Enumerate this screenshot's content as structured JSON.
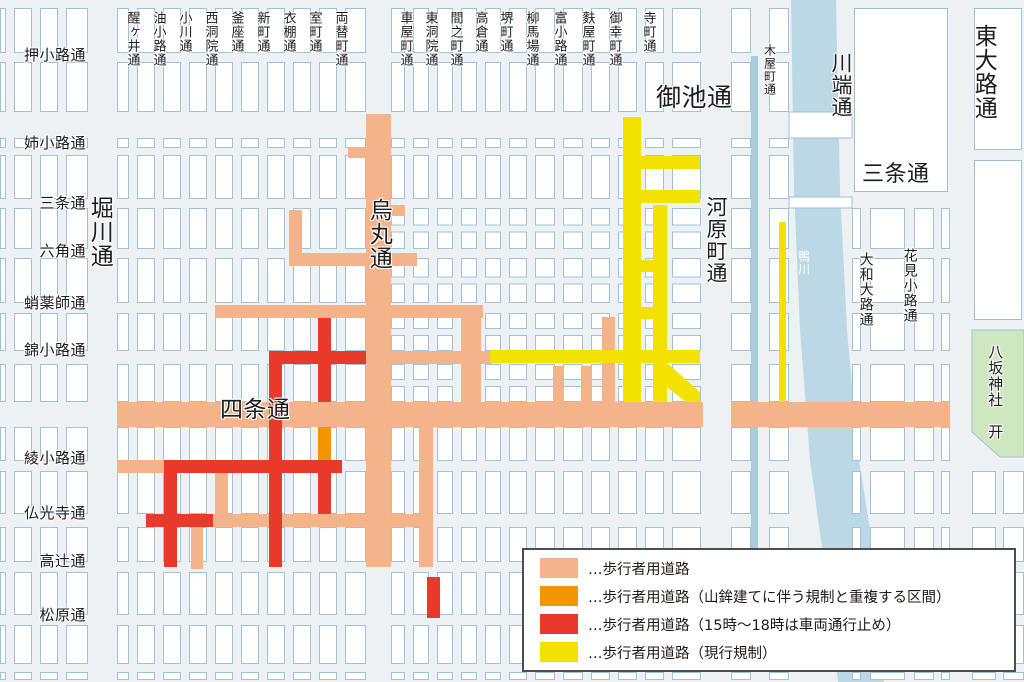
{
  "map_title": "祇園祭 歩行者用道路規制図",
  "colors": {
    "background": "#edf1f3",
    "block_fill": "#ffffff",
    "block_stroke": "#a0c2d2",
    "pedestrian": "#f4b388",
    "overlap": "#f29600",
    "timed": "#e8392b",
    "current": "#f3e100",
    "river": "#bcd8e6",
    "canal": "#a9cbde",
    "shrine_fill": "#cfe7c1",
    "label_color": "#1c1c1c",
    "river_label_color": "#ffffff",
    "legend_border": "#4d4d4d",
    "legend_text": "#231815"
  },
  "legend": {
    "items": [
      {
        "key": "pedestrian",
        "label": "…歩行者用道路"
      },
      {
        "key": "overlap",
        "label": "…歩行者用道路（山鉾建てに伴う規制と重複する区間）"
      },
      {
        "key": "timed",
        "label": "…歩行者用道路（15時〜18時は車両通行止め）"
      },
      {
        "key": "current",
        "label": "…歩行者用道路（現行規制）"
      }
    ]
  },
  "labels": {
    "top_vertical": [
      {
        "text": "醒ヶ井通",
        "x": 133
      },
      {
        "text": "油小路通",
        "x": 159
      },
      {
        "text": "小川通",
        "x": 185
      },
      {
        "text": "西洞院通",
        "x": 211
      },
      {
        "text": "釜座通",
        "x": 237
      },
      {
        "text": "新町通",
        "x": 263
      },
      {
        "text": "衣棚通",
        "x": 289
      },
      {
        "text": "室町通",
        "x": 315
      },
      {
        "text": "両替町通",
        "x": 341
      },
      {
        "text": "車屋町通",
        "x": 406
      },
      {
        "text": "東洞院通",
        "x": 431
      },
      {
        "text": "間之町通",
        "x": 456
      },
      {
        "text": "高倉通",
        "x": 481
      },
      {
        "text": "堺町通",
        "x": 506
      },
      {
        "text": "柳馬場通",
        "x": 532
      },
      {
        "text": "富小路通",
        "x": 560
      },
      {
        "text": "麩屋町通",
        "x": 588
      },
      {
        "text": "御幸町通",
        "x": 615
      },
      {
        "text": "寺町通",
        "x": 649
      }
    ],
    "left_horizontal": [
      {
        "text": "押小路通",
        "y": 57
      },
      {
        "text": "姉小路通",
        "y": 145
      },
      {
        "text": "三条通",
        "y": 205
      },
      {
        "text": "六角通",
        "y": 253
      },
      {
        "text": "蛸薬師通",
        "y": 305
      },
      {
        "text": "錦小路通",
        "y": 352
      },
      {
        "text": "綾小路通",
        "y": 460
      },
      {
        "text": "仏光寺通",
        "y": 515
      },
      {
        "text": "高辻通",
        "y": 563
      },
      {
        "text": "松原通",
        "y": 617
      }
    ],
    "major": [
      {
        "text": "堀川通",
        "x": 99,
        "y": 196,
        "dir": "v",
        "size": 23
      },
      {
        "text": "烏丸通",
        "x": 378,
        "y": 198,
        "dir": "v",
        "size": 23
      },
      {
        "text": "四条通",
        "x": 220,
        "y": 398,
        "dir": "h",
        "size": 23
      },
      {
        "text": "御池通",
        "x": 656,
        "y": 84,
        "dir": "h",
        "size": 25
      },
      {
        "text": "河原町通",
        "x": 716,
        "y": 196,
        "dir": "v",
        "size": 21
      },
      {
        "text": "川端通",
        "x": 841,
        "y": 52,
        "dir": "v",
        "size": 21
      },
      {
        "text": "東大路通",
        "x": 983,
        "y": 24,
        "dir": "v",
        "size": 23
      },
      {
        "text": "三条通",
        "x": 862,
        "y": 163,
        "dir": "h",
        "size": 22
      },
      {
        "text": "木屋町通",
        "x": 770,
        "y": 44,
        "dir": "v",
        "size": 12
      },
      {
        "text": "大和大路通",
        "x": 866,
        "y": 252,
        "dir": "v",
        "size": 14
      },
      {
        "text": "花見小路通",
        "x": 910,
        "y": 248,
        "dir": "v",
        "size": 14
      },
      {
        "text": "八坂神社　开",
        "x": 996,
        "y": 344,
        "dir": "v",
        "size": 15
      },
      {
        "text": "鴨川",
        "x": 804,
        "y": 250,
        "dir": "v",
        "size": 12,
        "color": "#ffffff",
        "nohalo": true
      }
    ]
  },
  "roads": {
    "pedestrian": [
      [
        117,
        402,
        586,
        25
      ],
      [
        731,
        402,
        219,
        25
      ],
      [
        366,
        114,
        25,
        453
      ],
      [
        215,
        305,
        268,
        13
      ],
      [
        391,
        351,
        101,
        13
      ],
      [
        117,
        460,
        60,
        13
      ],
      [
        213,
        514,
        217,
        13
      ],
      [
        461,
        318,
        20,
        84
      ],
      [
        215,
        462,
        13,
        57
      ],
      [
        191,
        525,
        12,
        44
      ],
      [
        419,
        427,
        14,
        140
      ],
      [
        348,
        147,
        18,
        11
      ],
      [
        387,
        205,
        18,
        11
      ],
      [
        289,
        210,
        13,
        56
      ],
      [
        289,
        253,
        128,
        13
      ],
      [
        553,
        366,
        11,
        36
      ],
      [
        581,
        366,
        11,
        36
      ],
      [
        602,
        317,
        13,
        85
      ]
    ],
    "overlap": [
      [
        318,
        427,
        13,
        35
      ]
    ],
    "timed": [
      [
        270,
        351,
        96,
        13
      ],
      [
        164,
        460,
        178,
        13
      ],
      [
        146,
        514,
        67,
        13
      ],
      [
        318,
        318,
        13,
        84
      ],
      [
        318,
        462,
        13,
        52
      ],
      [
        269,
        351,
        13,
        216
      ],
      [
        164,
        466,
        13,
        101
      ],
      [
        427,
        577,
        13,
        41
      ]
    ],
    "current": [
      [
        623,
        117,
        18,
        285
      ],
      [
        653,
        205,
        14,
        197
      ],
      [
        623,
        156,
        77,
        13
      ],
      [
        623,
        190,
        77,
        13
      ],
      [
        490,
        350,
        210,
        13
      ],
      [
        623,
        260,
        44,
        12
      ],
      [
        623,
        307,
        44,
        12
      ],
      [
        779,
        222,
        7,
        180
      ]
    ],
    "current_polys": [
      [
        [
          653,
          363
        ],
        [
          667,
          363
        ],
        [
          700,
          392
        ],
        [
          700,
          402
        ],
        [
          686,
          402
        ],
        [
          653,
          376
        ]
      ]
    ]
  },
  "river": {
    "name": "鴨川"
  },
  "shrine": {
    "name": "八坂神社",
    "symbol": "开"
  }
}
